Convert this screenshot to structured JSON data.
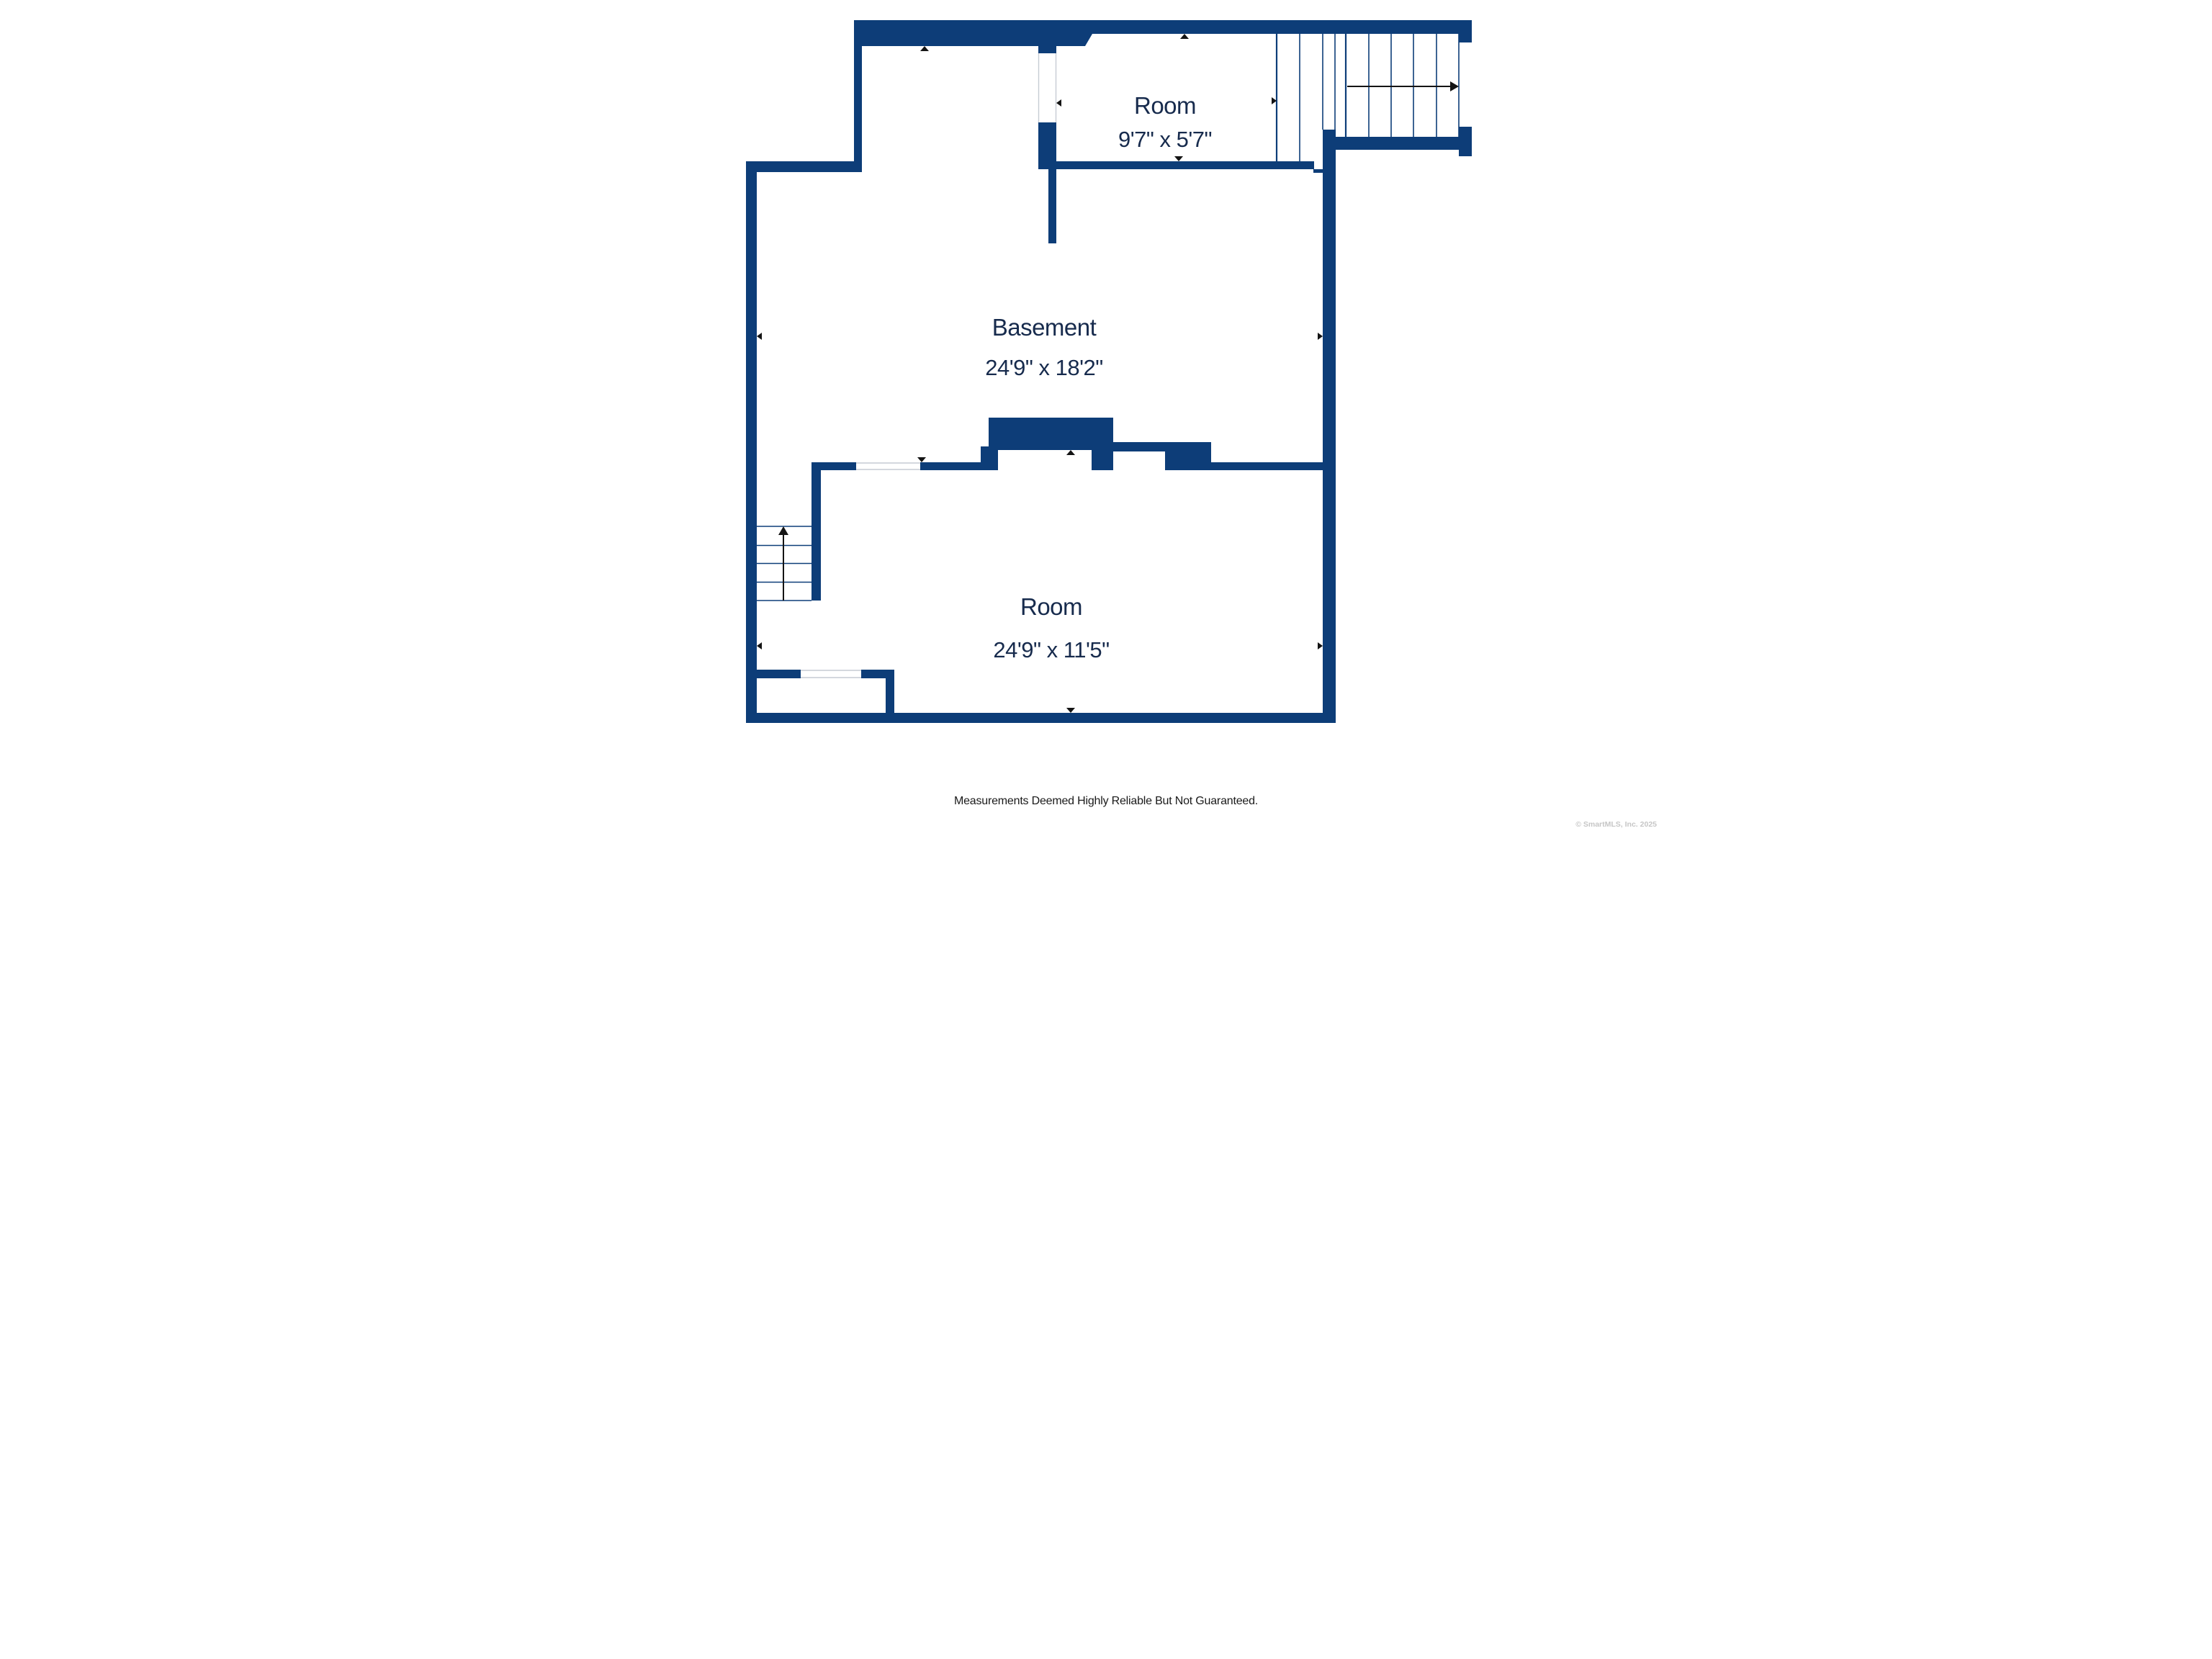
{
  "colors": {
    "bg": "#ffffff",
    "wall": "#0d3d78",
    "label": "#172b4d",
    "marker": "#141414",
    "opening": "#c6ccd4",
    "text": "#1a1a1a",
    "muted": "#c6c6c6"
  },
  "plan": {
    "rooms": [
      {
        "id": "room_top",
        "name": "Room",
        "dims": "9'7\" x 5'7\""
      },
      {
        "id": "basement",
        "name": "Basement",
        "dims": "24'9\" x 18'2\""
      },
      {
        "id": "room_bottom",
        "name": "Room",
        "dims": "24'9\" x 11'5\""
      }
    ],
    "stairs": [
      {
        "id": "upper_right_stairs",
        "direction": "right",
        "treads": 6
      },
      {
        "id": "lower_left_stairs",
        "direction": "up",
        "treads": 4
      }
    ],
    "icons": {
      "measure_up": "▲",
      "measure_down": "▼",
      "measure_left": "◀",
      "measure_right": "▶",
      "stair_direction_up": "↑",
      "stair_direction_right": "→"
    }
  },
  "footer": {
    "disclaimer": "Measurements Deemed Highly Reliable But Not Guaranteed."
  },
  "watermark": {
    "text": "© SmartMLS, Inc. 2025"
  }
}
